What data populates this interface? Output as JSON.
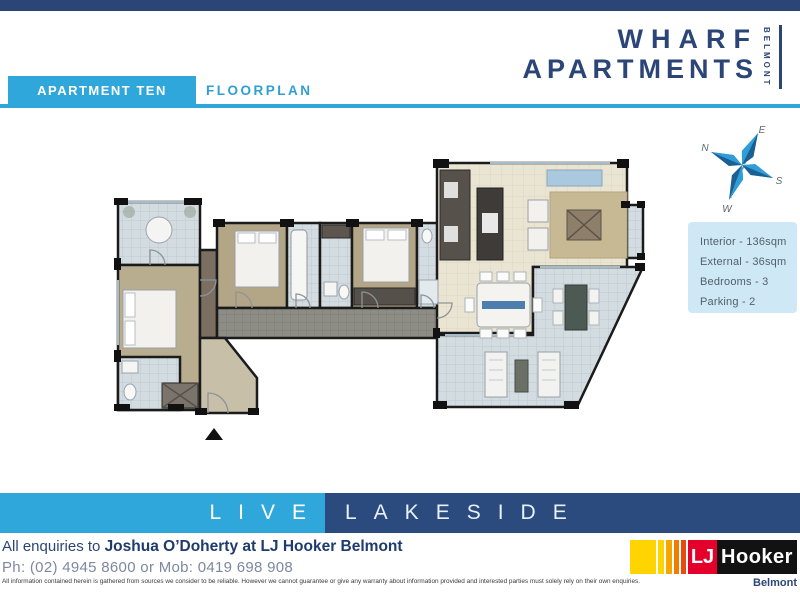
{
  "header": {
    "tab_label": "APARTMENT TEN",
    "section_label": "FLOORPLAN",
    "brand_line1": "WHARF",
    "brand_line2": "APARTMENTS",
    "brand_vertical": "BELMONT"
  },
  "compass": {
    "north": "N",
    "east": "E",
    "south": "S",
    "west": "W"
  },
  "summary": {
    "interior": "Interior - 136sqm",
    "external": "External - 36sqm",
    "bedrooms": "Bedrooms - 3",
    "parking": "Parking -  2"
  },
  "banner": {
    "left": "LIVE",
    "right": "LAKESIDE"
  },
  "contact": {
    "prefix": "All enquiries to",
    "agent": "Joshua O’Doherty at LJ Hooker Belmont",
    "phones": "Ph: (02) 4945 8600 or Mob: 0419 698 908",
    "disclaimer": "All information contained herein is gathered from sources we consider to be reliable.  However we cannot guarantee or give any warranty about information provided and interested parties must solely rely on their own enquiries."
  },
  "agency": {
    "lj": "LJ",
    "hooker": "Hooker",
    "office": "Belmont"
  },
  "colors": {
    "accent_blue": "#2fa7db",
    "navy": "#2c4577",
    "banner_navy": "#2b4a7e",
    "info_box_bg": "#cfe8f6",
    "lj_red": "#e4002b",
    "lj_yellow": "#ffd400"
  }
}
